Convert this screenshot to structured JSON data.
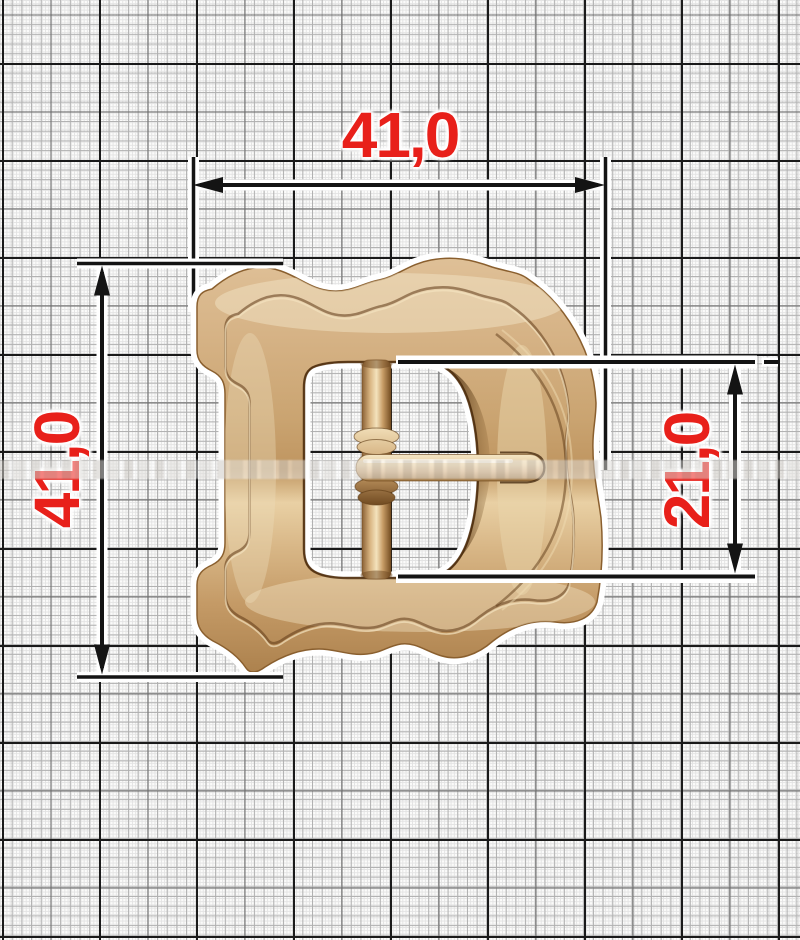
{
  "dimensions": {
    "width_mm": {
      "label": "41,0"
    },
    "height_mm": {
      "label": "41,0"
    },
    "inner_height_mm": {
      "label": "21,0"
    }
  },
  "colors": {
    "dim_text": "#e8201a",
    "dim_line": "#141414",
    "dim_casing": "#ffffff",
    "paper": "#fbfbfa",
    "grid_heavy": "#1a1a1a",
    "grid_medium": "#6a6a6a",
    "grid_fine": "#b0b0b0",
    "grid_hairline": "#e3e3e3",
    "buckle_gold": "#d2ab7c",
    "buckle_gold_light": "#f2e3c2",
    "buckle_gold_dark": "#7a5226"
  }
}
